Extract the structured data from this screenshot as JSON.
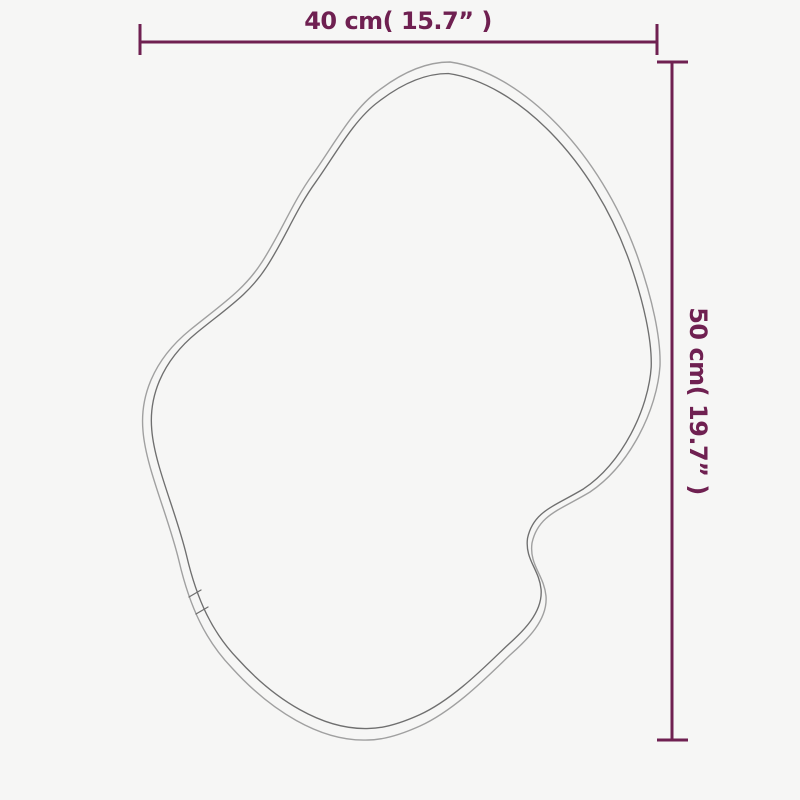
{
  "meta": {
    "background_color": "#f6f6f5",
    "accent_color": "#6f2051",
    "outline_outer_color": "#a0a0a0",
    "outline_inner_color": "#6f6f6f",
    "figure": "irregular-organic-mirror-outline"
  },
  "dimensions": {
    "width": {
      "label": "40 cm( 15.7” )",
      "cm": 40,
      "inches": 15.7
    },
    "height": {
      "label": "50 cm( 19.7” )",
      "cm": 50,
      "inches": 19.7
    }
  }
}
